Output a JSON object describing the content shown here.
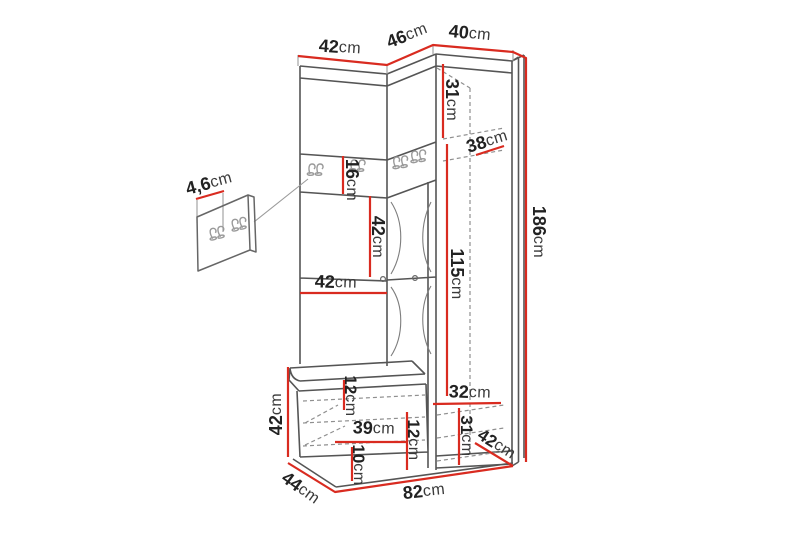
{
  "figure": {
    "kind": "furniture-dimension-diagram",
    "colors": {
      "dimension_line": "#d92b20",
      "outline": "#4f4f4f",
      "hidden_line": "#8f8f8f",
      "label_text": "#222222"
    }
  },
  "dimensions": {
    "top_left_width": {
      "value": "42",
      "unit": "cm"
    },
    "top_angled_width": {
      "value": "46",
      "unit": "cm"
    },
    "top_right_width": {
      "value": "40",
      "unit": "cm"
    },
    "upper_shelf_height": {
      "value": "31",
      "unit": "cm"
    },
    "shelf_depth": {
      "value": "38",
      "unit": "cm"
    },
    "total_height": {
      "value": "186",
      "unit": "cm"
    },
    "hook_strip_height": {
      "value": "16",
      "unit": "cm"
    },
    "mirror_door_height": {
      "value": "42",
      "unit": "cm"
    },
    "mirror_door_width": {
      "value": "42",
      "unit": "cm"
    },
    "wardrobe_inner_height": {
      "value": "115",
      "unit": "cm"
    },
    "hook_panel_thickness": {
      "value": "4,6",
      "unit": "cm"
    },
    "bench_side_height": {
      "value": "42",
      "unit": "cm"
    },
    "seat_thickness": {
      "value": "12",
      "unit": "cm"
    },
    "bench_inner_width": {
      "value": "39",
      "unit": "cm"
    },
    "bench_divider_height": {
      "value": "12",
      "unit": "cm"
    },
    "bench_shelf_height": {
      "value": "10",
      "unit": "cm"
    },
    "wardrobe_bottom_width": {
      "value": "32",
      "unit": "cm"
    },
    "wardrobe_bottom_height": {
      "value": "31",
      "unit": "cm"
    },
    "wardrobe_depth": {
      "value": "42",
      "unit": "cm"
    },
    "bench_depth": {
      "value": "44",
      "unit": "cm"
    },
    "total_width": {
      "value": "82",
      "unit": "cm"
    }
  }
}
